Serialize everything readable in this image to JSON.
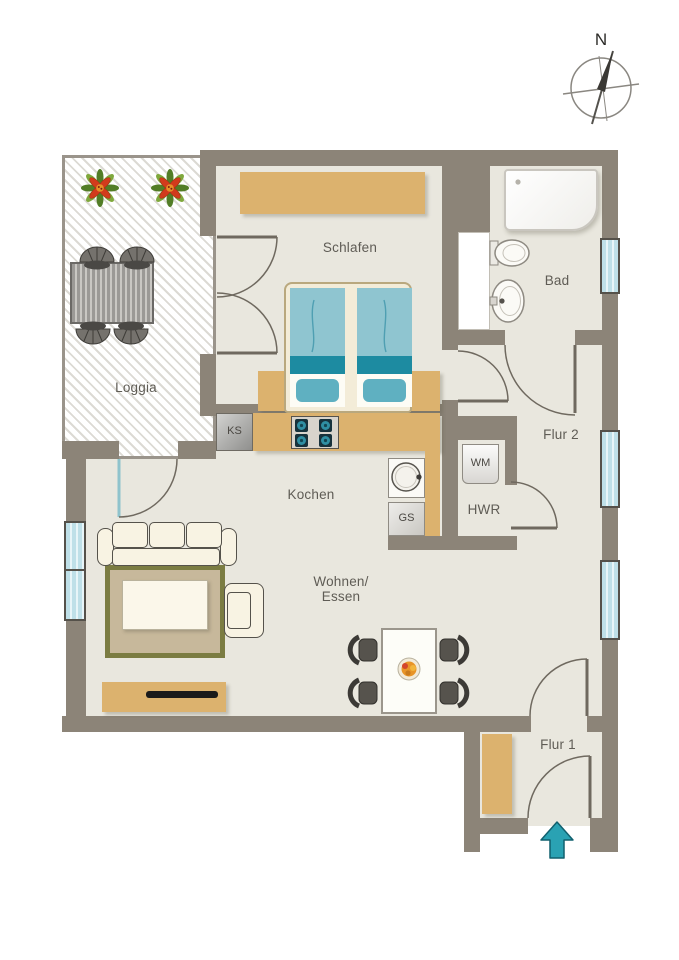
{
  "compass": {
    "north_label": "N"
  },
  "rooms": {
    "schlafen": "Schlafen",
    "bad": "Bad",
    "loggia": "Loggia",
    "flur2": "Flur 2",
    "kochen": "Kochen",
    "hwr": "HWR",
    "wohnen_essen_line1": "Wohnen/",
    "wohnen_essen_line2": "Essen",
    "flur1": "Flur 1"
  },
  "appliances": {
    "fridge": "KS",
    "dishwasher": "GS",
    "washing_machine": "WM"
  },
  "colors": {
    "wall": "#8c8478",
    "floor": "#e9e7de",
    "furniture_tan": "#dcb26e",
    "bed_teal": "#8fc5d0",
    "bed_teal_dark": "#1d8ba1",
    "window_glass": "#c4e3ea",
    "entry_arrow": "#2aa2b3",
    "rug_border": "#7b7c42"
  }
}
